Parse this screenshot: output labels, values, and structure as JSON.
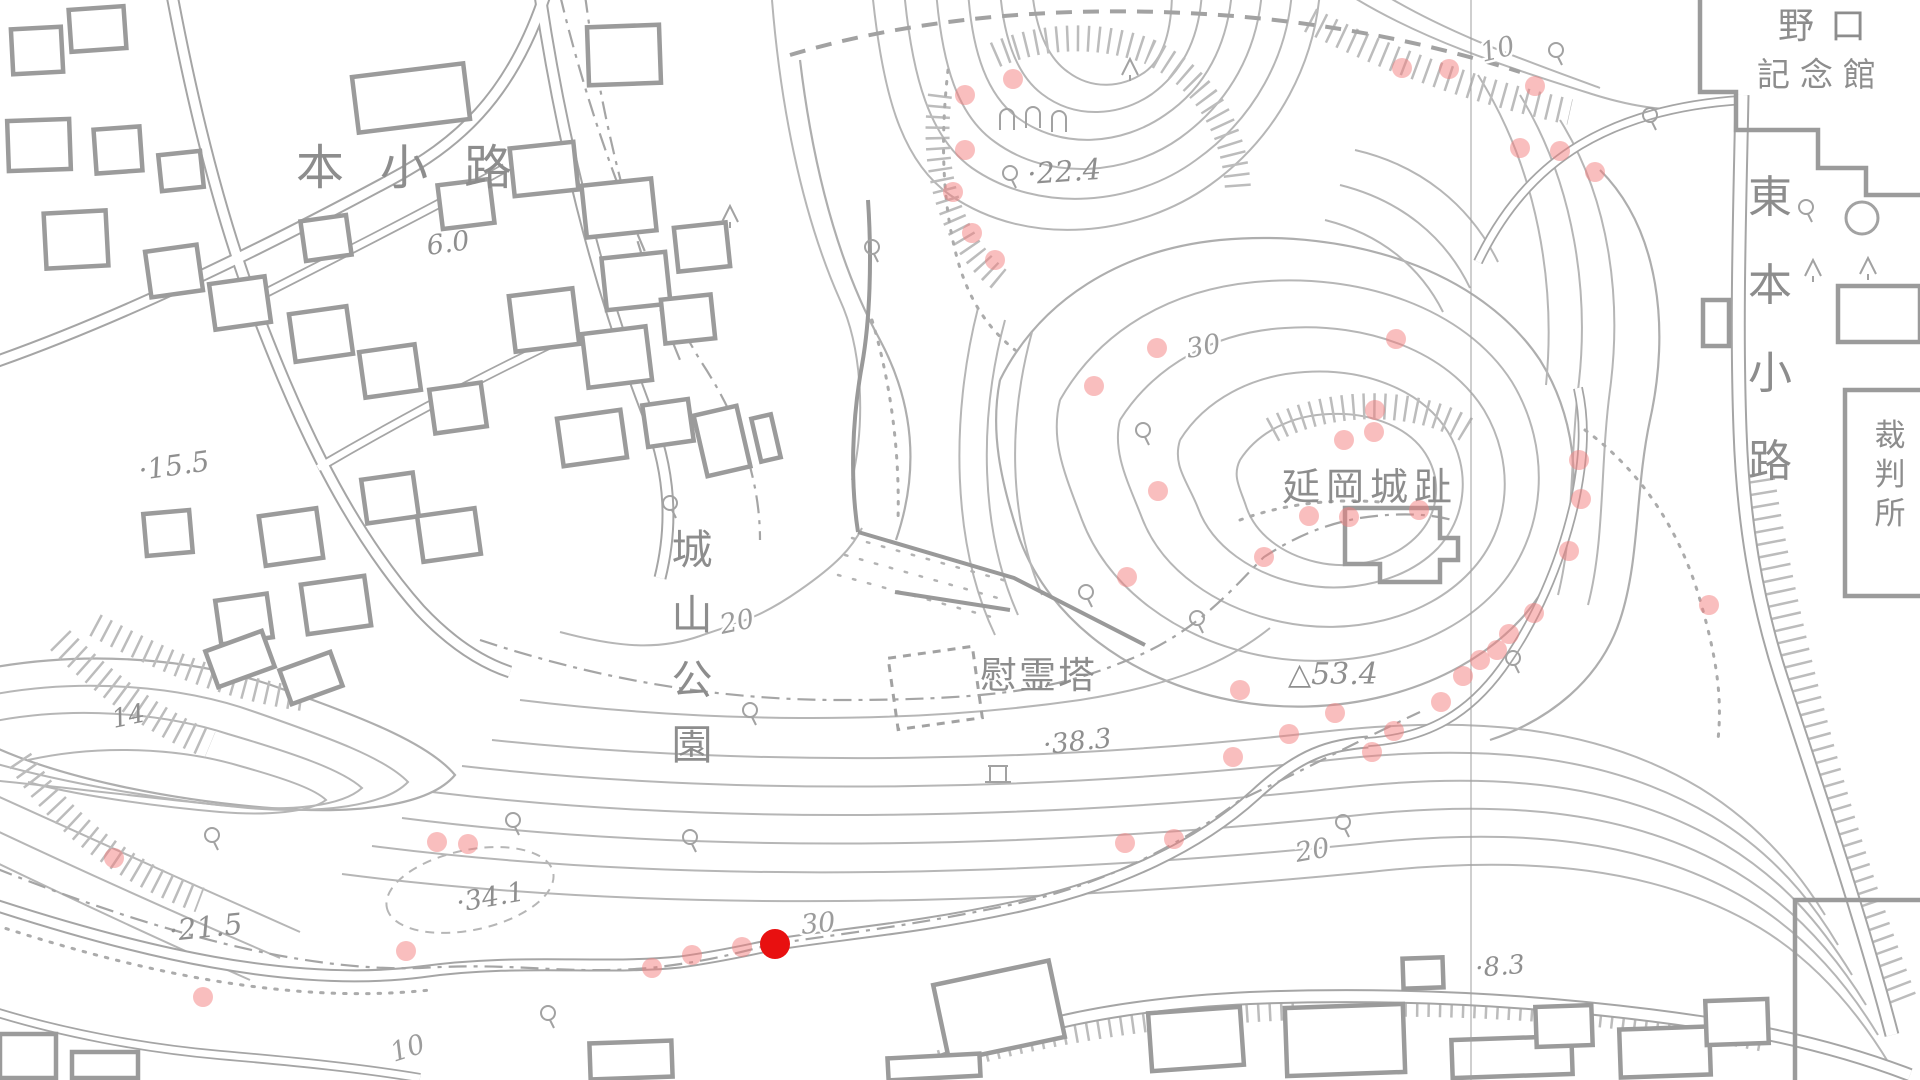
{
  "map_name": "Shiroyama Park / Nobeoka Castle ruins topographic map",
  "colors": {
    "map_line": "#b0b0b0",
    "map_text": "#8d8d8d",
    "survey_dot": "#f47d7d",
    "survey_dot_opacity": 0.5,
    "active_marker": "#e81010"
  },
  "place_labels": [
    {
      "id": "hon-kouji",
      "text": "本小路",
      "x": 296,
      "y": 184,
      "size": 48,
      "spacing": 36,
      "vertical": false
    },
    {
      "id": "noguchi-line1",
      "text": "野口",
      "x": 1778,
      "y": 38,
      "size": 36,
      "spacing": 16,
      "vertical": false
    },
    {
      "id": "noguchi-line2",
      "text": "記念館",
      "x": 1757,
      "y": 86,
      "size": 33,
      "spacing": 10,
      "vertical": false
    },
    {
      "id": "higashi-hon-kouji",
      "text": "東本小路",
      "x": 1770,
      "y": 212,
      "size": 44,
      "spacing": 44,
      "vertical": true
    },
    {
      "id": "saibansho",
      "text": "裁判所",
      "x": 1890,
      "y": 446,
      "size": 31,
      "spacing": 8,
      "vertical": true
    },
    {
      "id": "shiroyama-koen",
      "text": "城山公園",
      "x": 692,
      "y": 564,
      "size": 41,
      "spacing": 24,
      "vertical": true
    },
    {
      "id": "nobeoka-joshi",
      "text": "延岡城趾",
      "x": 1282,
      "y": 500,
      "size": 38,
      "spacing": 6,
      "vertical": false
    },
    {
      "id": "ireito",
      "text": "慰霊塔",
      "x": 980,
      "y": 688,
      "size": 37,
      "spacing": 2,
      "vertical": false
    }
  ],
  "elevation_labels": [
    {
      "text": "6.0",
      "x": 428,
      "y": 255,
      "size": 27,
      "rot": -8
    },
    {
      "text": "·22.4",
      "x": 1028,
      "y": 184,
      "size": 29,
      "rot": -4
    },
    {
      "text": "·15.5",
      "x": 140,
      "y": 480,
      "size": 28,
      "rot": -8
    },
    {
      "text": "14",
      "x": 114,
      "y": 728,
      "size": 26,
      "rot": -12
    },
    {
      "text": "·21.5",
      "x": 170,
      "y": 941,
      "size": 29,
      "rot": -6
    },
    {
      "text": "·34.1",
      "x": 458,
      "y": 912,
      "size": 27,
      "rot": -10
    },
    {
      "text": "·38.3",
      "x": 1044,
      "y": 754,
      "size": 27,
      "rot": -6
    },
    {
      "text": "△53.4",
      "x": 1288,
      "y": 684,
      "size": 30,
      "rot": 0
    },
    {
      "text": "·8.3",
      "x": 1476,
      "y": 977,
      "size": 26,
      "rot": -5
    }
  ],
  "contour_labels": [
    {
      "text": "10",
      "x": 1483,
      "y": 62,
      "rot": -14,
      "size": 27
    },
    {
      "text": "30",
      "x": 1188,
      "y": 358,
      "rot": -10,
      "size": 27
    },
    {
      "text": "20",
      "x": 722,
      "y": 634,
      "rot": -12,
      "size": 27
    },
    {
      "text": "30",
      "x": 802,
      "y": 934,
      "rot": -6,
      "size": 27
    },
    {
      "text": "20",
      "x": 1297,
      "y": 862,
      "rot": -10,
      "size": 27
    },
    {
      "text": "10",
      "x": 394,
      "y": 1062,
      "rot": -18,
      "size": 27
    }
  ],
  "markers": {
    "active": {
      "x": 775,
      "y": 944,
      "r": 15
    },
    "point_radius": 10,
    "points": [
      [
        1013,
        79
      ],
      [
        965,
        95
      ],
      [
        965,
        150
      ],
      [
        953,
        192
      ],
      [
        972,
        233
      ],
      [
        995,
        260
      ],
      [
        1402,
        68
      ],
      [
        1449,
        69
      ],
      [
        1535,
        86
      ],
      [
        1520,
        148
      ],
      [
        1560,
        151
      ],
      [
        1595,
        172
      ],
      [
        1396,
        339
      ],
      [
        1157,
        348
      ],
      [
        1094,
        386
      ],
      [
        1158,
        491
      ],
      [
        1127,
        577
      ],
      [
        1344,
        440
      ],
      [
        1375,
        410
      ],
      [
        1374,
        432
      ],
      [
        1309,
        516
      ],
      [
        1349,
        517
      ],
      [
        1419,
        510
      ],
      [
        1264,
        557
      ],
      [
        1579,
        460
      ],
      [
        1581,
        499
      ],
      [
        1569,
        551
      ],
      [
        1534,
        613
      ],
      [
        1509,
        634
      ],
      [
        1497,
        650
      ],
      [
        1480,
        660
      ],
      [
        1463,
        676
      ],
      [
        1441,
        702
      ],
      [
        1394,
        731
      ],
      [
        1372,
        752
      ],
      [
        1335,
        713
      ],
      [
        1289,
        734
      ],
      [
        1240,
        690
      ],
      [
        1233,
        757
      ],
      [
        1709,
        605
      ],
      [
        1125,
        843
      ],
      [
        1174,
        839
      ],
      [
        437,
        842
      ],
      [
        468,
        844
      ],
      [
        406,
        951
      ],
      [
        652,
        968
      ],
      [
        692,
        955
      ],
      [
        742,
        947
      ],
      [
        203,
        997
      ],
      [
        114,
        858
      ]
    ]
  }
}
